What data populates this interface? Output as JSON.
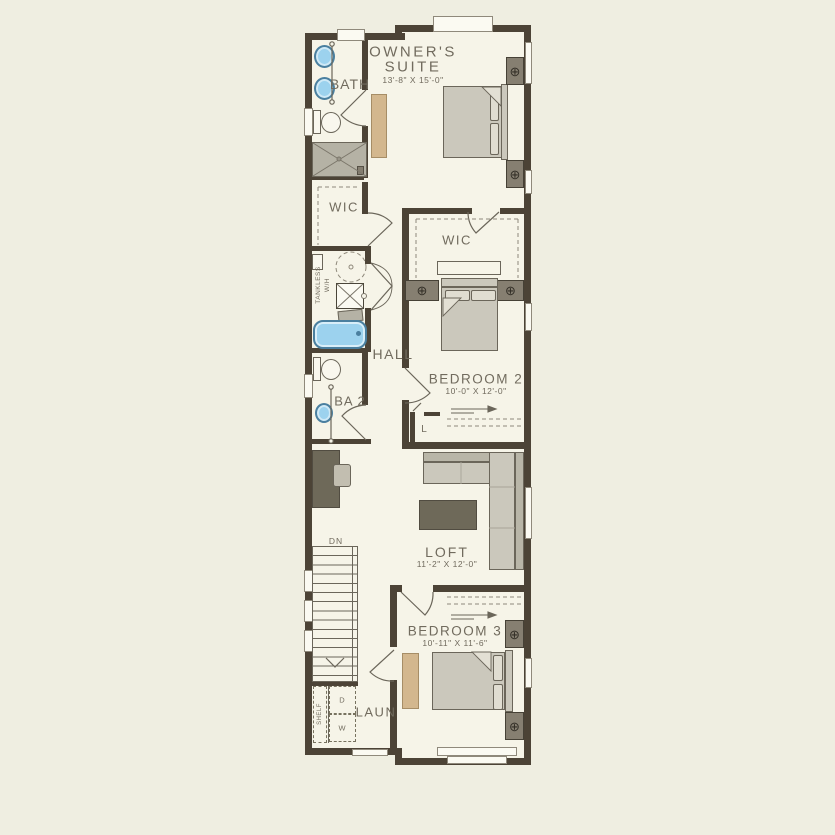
{
  "rooms": {
    "owners_suite": {
      "line1": "OWNER'S",
      "line2": "SUITE",
      "dims": "13'-8\" X 15'-0\""
    },
    "bath": {
      "name": "BATH"
    },
    "wic_owners": {
      "name": "WIC"
    },
    "wic_bedroom2": {
      "name": "WIC"
    },
    "hall": {
      "name": "HALL"
    },
    "ba2": {
      "name": "BA 2"
    },
    "bedroom2": {
      "name": "BEDROOM 2",
      "dims": "10'-0\" X 12'-0\""
    },
    "linen_closet": {
      "name": "L"
    },
    "loft": {
      "name": "LOFT",
      "dims": "11'-2\" X 12'-0\""
    },
    "bedroom3": {
      "name": "BEDROOM 3",
      "dims": "10'-11\" X 11'-6\""
    },
    "laundry": {
      "name": "LAUN"
    }
  },
  "annotations": {
    "stairs_direction": "DN",
    "tankless_line1": "TANKLESS",
    "tankless_line2": "W/H",
    "shelf": "SHELF",
    "dryer": "D",
    "washer": "W"
  },
  "icons": {
    "lamp_symbol": "⊕"
  },
  "colors": {
    "background": "#efeee1",
    "floor": "#f6f4e8",
    "wall": "#4c4336",
    "furniture_outline": "#6b665a",
    "furniture_fill": "#cbc8bc",
    "accent_tan": "#d3b78e",
    "fixture_blue": "#9cd2ee",
    "dark_furniture": "#6e6959",
    "nightstand": "#867f71",
    "label_text": "#716b5e"
  }
}
